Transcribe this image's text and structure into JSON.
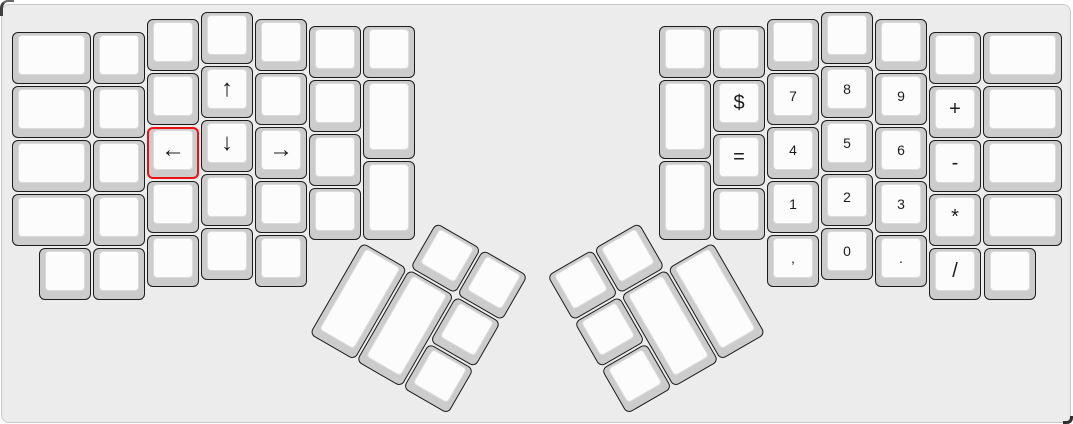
{
  "app": {
    "description": "Keyboard layout editor canvas showing an ErgoDox split ergonomic keyboard",
    "selected_key_label": "←"
  },
  "colors": {
    "page_bg": "#ffffff",
    "canvas_bg": "#ececec",
    "canvas_border": "#c9c9c9",
    "key_base": "#cccccc",
    "key_border": "#1c1c1c",
    "key_top": "#fcfcfc",
    "key_top_border": "#dcdcdc",
    "selected_key_border": "#ee1111",
    "label_color": "#1c1c1c"
  },
  "keyboard": {
    "unit_px": 54,
    "rotation_groups": {
      "left-thumb": {
        "r": 30,
        "rx": 361,
        "ry": 239.5
      },
      "right-thumb": {
        "r": -30,
        "rx": 712,
        "ry": 239.5
      }
    },
    "keys": [
      {
        "name": "key-l-c0-r0",
        "label": "",
        "x": 10,
        "y": 30.25,
        "w": 81,
        "h": 54
      },
      {
        "name": "key-l-c0-r1",
        "label": "",
        "x": 10,
        "y": 84.25,
        "w": 81,
        "h": 54
      },
      {
        "name": "key-l-c0-r2",
        "label": "",
        "x": 10,
        "y": 138.25,
        "w": 81,
        "h": 54
      },
      {
        "name": "key-l-c0-r3",
        "label": "",
        "x": 10,
        "y": 192.25,
        "w": 81,
        "h": 54
      },
      {
        "name": "key-l-c1-r0",
        "label": "",
        "x": 91,
        "y": 30.25,
        "w": 54,
        "h": 54
      },
      {
        "name": "key-l-c1-r1",
        "label": "",
        "x": 91,
        "y": 84.25,
        "w": 54,
        "h": 54
      },
      {
        "name": "key-l-c1-r2",
        "label": "",
        "x": 91,
        "y": 138.25,
        "w": 54,
        "h": 54
      },
      {
        "name": "key-l-c1-r3",
        "label": "",
        "x": 91,
        "y": 192.25,
        "w": 54,
        "h": 54
      },
      {
        "name": "key-l-c2-r0",
        "label": "",
        "x": 145,
        "y": 16.75,
        "w": 54,
        "h": 54
      },
      {
        "name": "key-l-c2-r1",
        "label": "",
        "x": 145,
        "y": 70.75,
        "w": 54,
        "h": 54
      },
      {
        "name": "key-arrow-left",
        "label": "←",
        "x": 145,
        "y": 124.75,
        "w": 54,
        "h": 54,
        "font_size": 24,
        "selected": true
      },
      {
        "name": "key-l-c2-r3",
        "label": "",
        "x": 145,
        "y": 178.75,
        "w": 54,
        "h": 54
      },
      {
        "name": "key-l-c2-r4",
        "label": "",
        "x": 145,
        "y": 232.75,
        "w": 54,
        "h": 54
      },
      {
        "name": "key-l-c3-r0",
        "label": "",
        "x": 199,
        "y": 10,
        "w": 54,
        "h": 54
      },
      {
        "name": "key-arrow-up",
        "label": "↑",
        "x": 199,
        "y": 64,
        "w": 54,
        "h": 54,
        "font_size": 24
      },
      {
        "name": "key-arrow-down",
        "label": "↓",
        "x": 199,
        "y": 118,
        "w": 54,
        "h": 54,
        "font_size": 24
      },
      {
        "name": "key-l-c3-r3",
        "label": "",
        "x": 199,
        "y": 172,
        "w": 54,
        "h": 54
      },
      {
        "name": "key-l-c3-r4",
        "label": "",
        "x": 199,
        "y": 226,
        "w": 54,
        "h": 54
      },
      {
        "name": "key-l-c4-r0",
        "label": "",
        "x": 253,
        "y": 16.75,
        "w": 54,
        "h": 54
      },
      {
        "name": "key-l-c4-r1",
        "label": "",
        "x": 253,
        "y": 70.75,
        "w": 54,
        "h": 54
      },
      {
        "name": "key-arrow-right",
        "label": "→",
        "x": 253,
        "y": 124.75,
        "w": 54,
        "h": 54,
        "font_size": 24
      },
      {
        "name": "key-l-c4-r3",
        "label": "",
        "x": 253,
        "y": 178.75,
        "w": 54,
        "h": 54
      },
      {
        "name": "key-l-c4-r4",
        "label": "",
        "x": 253,
        "y": 232.75,
        "w": 54,
        "h": 54
      },
      {
        "name": "key-l-c5-r0",
        "label": "",
        "x": 307,
        "y": 23.5,
        "w": 54,
        "h": 54
      },
      {
        "name": "key-l-c5-r1",
        "label": "",
        "x": 307,
        "y": 77.5,
        "w": 54,
        "h": 54
      },
      {
        "name": "key-l-c5-r2",
        "label": "",
        "x": 307,
        "y": 131.5,
        "w": 54,
        "h": 54
      },
      {
        "name": "key-l-c5-r3",
        "label": "",
        "x": 307,
        "y": 185.5,
        "w": 54,
        "h": 54
      },
      {
        "name": "key-l-c6-r0",
        "label": "",
        "x": 361,
        "y": 23.5,
        "w": 54,
        "h": 54
      },
      {
        "name": "key-l-c6-r1",
        "label": "",
        "x": 361,
        "y": 77.5,
        "w": 54,
        "h": 81
      },
      {
        "name": "key-l-c6-r2",
        "label": "",
        "x": 361,
        "y": 158.5,
        "w": 54,
        "h": 81
      },
      {
        "name": "key-l-bottom-1",
        "label": "",
        "x": 37,
        "y": 246.25,
        "w": 54,
        "h": 54
      },
      {
        "name": "key-l-bottom-2",
        "label": "",
        "x": 91,
        "y": 246.25,
        "w": 54,
        "h": 54
      },
      {
        "name": "key-lthumb-a",
        "label": "",
        "x": 54,
        "y": -54,
        "w": 54,
        "h": 54,
        "group": "left-thumb"
      },
      {
        "name": "key-lthumb-b",
        "label": "",
        "x": 108,
        "y": -54,
        "w": 54,
        "h": 54,
        "group": "left-thumb"
      },
      {
        "name": "key-lthumb-c",
        "label": "",
        "x": 0,
        "y": 0,
        "w": 54,
        "h": 108,
        "group": "left-thumb"
      },
      {
        "name": "key-lthumb-d",
        "label": "",
        "x": 54,
        "y": 0,
        "w": 54,
        "h": 108,
        "group": "left-thumb"
      },
      {
        "name": "key-lthumb-e",
        "label": "",
        "x": 108,
        "y": 0,
        "w": 54,
        "h": 54,
        "group": "left-thumb"
      },
      {
        "name": "key-lthumb-f",
        "label": "",
        "x": 108,
        "y": 54,
        "w": 54,
        "h": 54,
        "group": "left-thumb"
      },
      {
        "name": "key-r-c0-r0",
        "label": "",
        "x": 657,
        "y": 23.5,
        "w": 54,
        "h": 54
      },
      {
        "name": "key-r-c0-r1",
        "label": "",
        "x": 657,
        "y": 77.5,
        "w": 54,
        "h": 81
      },
      {
        "name": "key-r-c0-r2",
        "label": "",
        "x": 657,
        "y": 158.5,
        "w": 54,
        "h": 81
      },
      {
        "name": "key-r-c1-r0",
        "label": "",
        "x": 711,
        "y": 23.5,
        "w": 54,
        "h": 54
      },
      {
        "name": "key-dollar",
        "label": "$",
        "x": 711,
        "y": 77.5,
        "w": 54,
        "h": 54,
        "font_size": 20
      },
      {
        "name": "key-equals",
        "label": "=",
        "x": 711,
        "y": 131.5,
        "w": 54,
        "h": 54,
        "font_size": 20
      },
      {
        "name": "key-r-c1-r3",
        "label": "",
        "x": 711,
        "y": 185.5,
        "w": 54,
        "h": 54
      },
      {
        "name": "key-r-c2-r0",
        "label": "",
        "x": 765,
        "y": 16.75,
        "w": 54,
        "h": 54
      },
      {
        "name": "key-num-7",
        "label": "7",
        "x": 765,
        "y": 70.75,
        "w": 54,
        "h": 54
      },
      {
        "name": "key-num-4",
        "label": "4",
        "x": 765,
        "y": 124.75,
        "w": 54,
        "h": 54
      },
      {
        "name": "key-num-1",
        "label": "1",
        "x": 765,
        "y": 178.75,
        "w": 54,
        "h": 54
      },
      {
        "name": "key-comma",
        "label": ",",
        "x": 765,
        "y": 232.75,
        "w": 54,
        "h": 54
      },
      {
        "name": "key-r-c3-r0",
        "label": "",
        "x": 819,
        "y": 10,
        "w": 54,
        "h": 54
      },
      {
        "name": "key-num-8",
        "label": "8",
        "x": 819,
        "y": 64,
        "w": 54,
        "h": 54
      },
      {
        "name": "key-num-5",
        "label": "5",
        "x": 819,
        "y": 118,
        "w": 54,
        "h": 54
      },
      {
        "name": "key-num-2",
        "label": "2",
        "x": 819,
        "y": 172,
        "w": 54,
        "h": 54
      },
      {
        "name": "key-num-0",
        "label": "0",
        "x": 819,
        "y": 226,
        "w": 54,
        "h": 54
      },
      {
        "name": "key-r-c4-r0",
        "label": "",
        "x": 873,
        "y": 16.75,
        "w": 54,
        "h": 54
      },
      {
        "name": "key-num-9",
        "label": "9",
        "x": 873,
        "y": 70.75,
        "w": 54,
        "h": 54
      },
      {
        "name": "key-num-6",
        "label": "6",
        "x": 873,
        "y": 124.75,
        "w": 54,
        "h": 54
      },
      {
        "name": "key-num-3",
        "label": "3",
        "x": 873,
        "y": 178.75,
        "w": 54,
        "h": 54
      },
      {
        "name": "key-period",
        "label": ".",
        "x": 873,
        "y": 232.75,
        "w": 54,
        "h": 54
      },
      {
        "name": "key-r-c5-r0",
        "label": "",
        "x": 927,
        "y": 30.25,
        "w": 54,
        "h": 54
      },
      {
        "name": "key-plus",
        "label": "+",
        "x": 927,
        "y": 84.25,
        "w": 54,
        "h": 54,
        "font_size": 20
      },
      {
        "name": "key-minus",
        "label": "-",
        "x": 927,
        "y": 138.25,
        "w": 54,
        "h": 54,
        "font_size": 20
      },
      {
        "name": "key-asterisk",
        "label": "*",
        "x": 927,
        "y": 192.25,
        "w": 54,
        "h": 54,
        "font_size": 20
      },
      {
        "name": "key-slash",
        "label": "/",
        "x": 927,
        "y": 246.25,
        "w": 54,
        "h": 54,
        "font_size": 20
      },
      {
        "name": "key-r-c6-r0",
        "label": "",
        "x": 981,
        "y": 30.25,
        "w": 81,
        "h": 54
      },
      {
        "name": "key-r-c6-r1",
        "label": "",
        "x": 981,
        "y": 84.25,
        "w": 81,
        "h": 54
      },
      {
        "name": "key-r-c6-r2",
        "label": "",
        "x": 981,
        "y": 138.25,
        "w": 81,
        "h": 54
      },
      {
        "name": "key-r-c6-r3",
        "label": "",
        "x": 981,
        "y": 192.25,
        "w": 81,
        "h": 54
      },
      {
        "name": "key-r-bottom-1",
        "label": "",
        "x": 982,
        "y": 246.25,
        "w": 54,
        "h": 54
      },
      {
        "name": "key-rthumb-b",
        "label": "",
        "x": -162,
        "y": -54,
        "w": 54,
        "h": 54,
        "group": "right-thumb"
      },
      {
        "name": "key-rthumb-a",
        "label": "",
        "x": -108,
        "y": -54,
        "w": 54,
        "h": 54,
        "group": "right-thumb"
      },
      {
        "name": "key-rthumb-d",
        "label": "",
        "x": -108,
        "y": 0,
        "w": 54,
        "h": 108,
        "group": "right-thumb"
      },
      {
        "name": "key-rthumb-c",
        "label": "",
        "x": -54,
        "y": 0,
        "w": 54,
        "h": 108,
        "group": "right-thumb"
      },
      {
        "name": "key-rthumb-e",
        "label": "",
        "x": -162,
        "y": 0,
        "w": 54,
        "h": 54,
        "group": "right-thumb"
      },
      {
        "name": "key-rthumb-f",
        "label": "",
        "x": -162,
        "y": 54,
        "w": 54,
        "h": 54,
        "group": "right-thumb"
      }
    ]
  }
}
